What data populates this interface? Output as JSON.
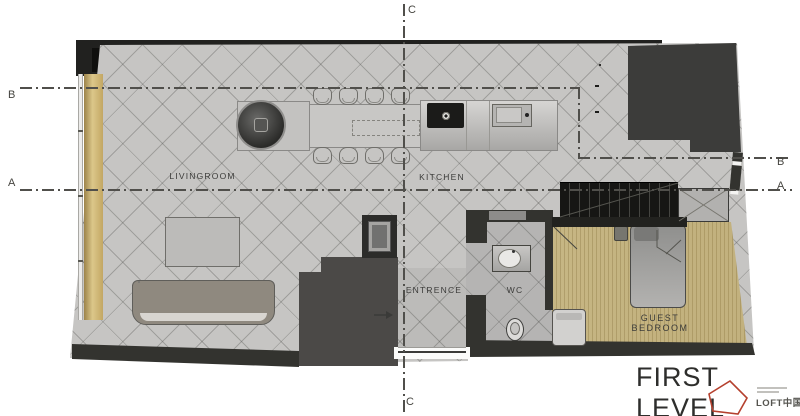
{
  "plan": {
    "title": "FIRST LEVEL",
    "rooms": {
      "livingroom": "LIVINGROOM",
      "kitchen": "KITCHEN",
      "entrance": "ENTRENCE",
      "wc": "WC",
      "guest_bedroom": "GUEST BEDROOM"
    },
    "sections": {
      "a": "A",
      "b": "B",
      "c": "C"
    }
  },
  "branding": {
    "logo_text": "LOFT中国",
    "logo_accent_color": "#b5402e"
  },
  "colors": {
    "wall_dark": "#33332f",
    "wall_block": "#3c3c3a",
    "floor_gray": "#c6c5c3",
    "window_wood": "#d4bd7e",
    "bedroom_wood": "#d0c293",
    "stairs_dark": "#161614",
    "accent_red": "#b5402e"
  }
}
